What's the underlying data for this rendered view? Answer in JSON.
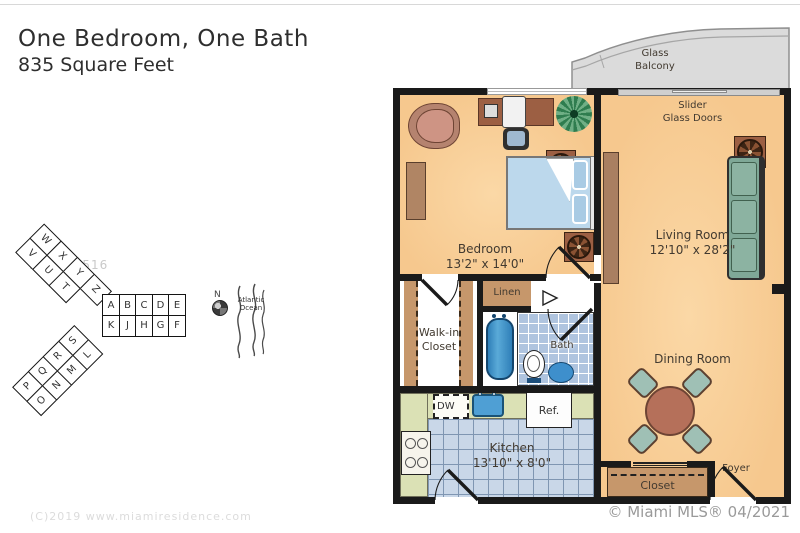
{
  "title": {
    "line1": "One Bedroom, One Bath",
    "line2": "835 Square Feet"
  },
  "floorplan": {
    "balcony": {
      "label": "Glass\nBalcony"
    },
    "slider": {
      "label": "Slider\nGlass Doors"
    },
    "bedroom": {
      "name": "Bedroom",
      "dims": "13'2\" x 14'0\""
    },
    "living": {
      "name": "Living Room",
      "dims": "12'10\" x 28'2\""
    },
    "dining": {
      "name": "Dining Room"
    },
    "kitchen": {
      "name": "Kitchen",
      "dims": "13'10\" x 8'0\""
    },
    "walkin_closet": {
      "label": "Walk-in\nCloset"
    },
    "linen": {
      "label": "Linen"
    },
    "bath": {
      "label": "Bath"
    },
    "closet": {
      "label": "Closet"
    },
    "foyer": {
      "label": "Foyer"
    },
    "appliances": {
      "dishwasher": "DW",
      "refrigerator": "Ref."
    }
  },
  "site_key": {
    "mls_watermark": "A11030516",
    "compass": "N",
    "ocean": "Atlantic\nOcean",
    "wing_right": {
      "top": [
        "A",
        "B",
        "C",
        "D",
        "E"
      ],
      "bottom": [
        "K",
        "J",
        "H",
        "G",
        "F"
      ]
    },
    "wing_upper": {
      "inner": [
        "W",
        "X",
        "Y",
        "Z"
      ],
      "outer": [
        "V",
        "U",
        "T"
      ]
    },
    "wing_lower": {
      "upper": [
        "P",
        "Q",
        "R",
        "S"
      ],
      "lower": [
        "O",
        "N",
        "M",
        "L"
      ]
    }
  },
  "footer": {
    "copyright": "(C)2019 www.miamiresidence.com",
    "mls": "© Miami MLS® 04/2021"
  },
  "colors": {
    "floor": "#F6C88E",
    "wall": "#1A1A1A",
    "balcony": "#DBDBDB",
    "counter": "#DBE1B5",
    "tile_kitchen": "#C9D7E8",
    "tile_bath": "#AFC4DF",
    "sofa": "#7FA897",
    "wood": "#C6976B",
    "water_fixture": "#4F9FD4"
  }
}
